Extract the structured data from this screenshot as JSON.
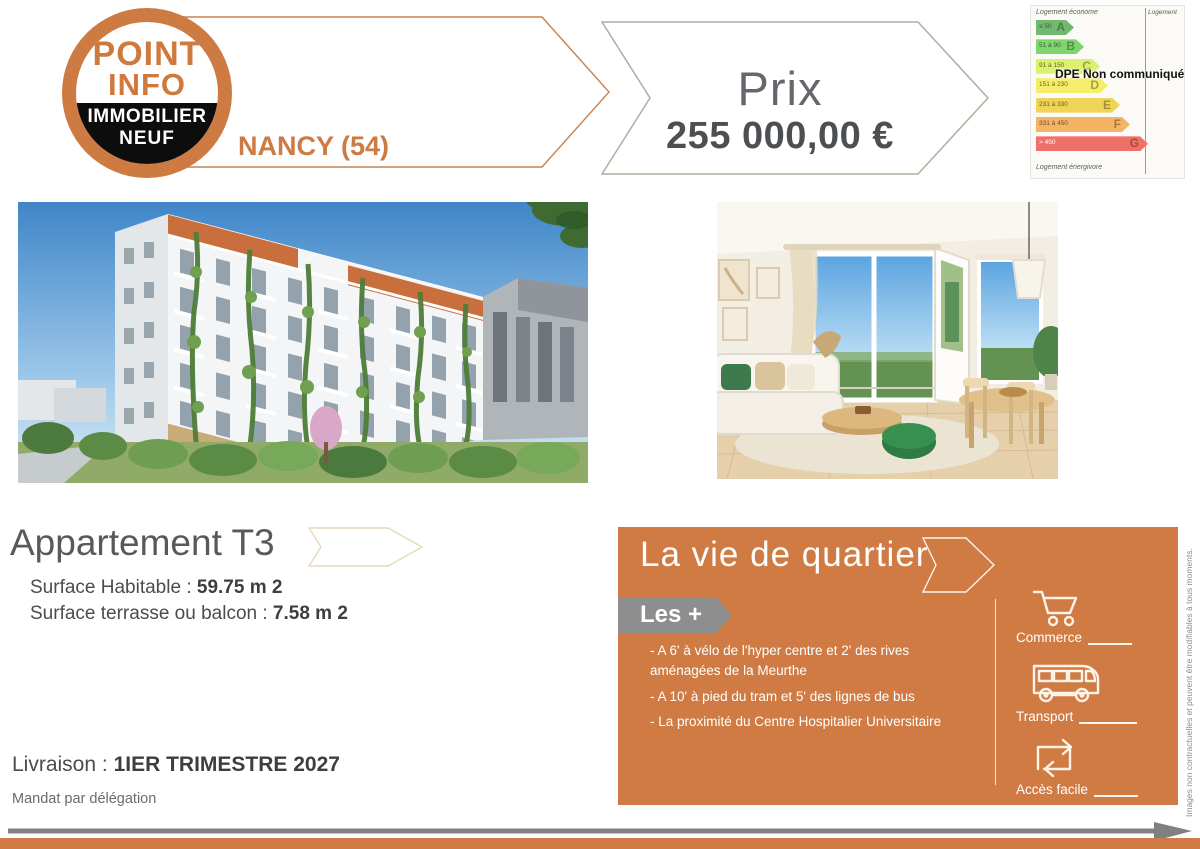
{
  "brand": {
    "logo_line1": "POINT",
    "logo_line2": "INFO",
    "logo_line3": "IMMOBILIER",
    "logo_line4": "NEUF",
    "city": "NANCY (54)",
    "orange": "#cd7a43"
  },
  "price": {
    "label": "Prix",
    "value": "255 000,00 €"
  },
  "dpe": {
    "top_label": "Logement économe",
    "bottom_label": "Logement énergivore",
    "right_label": "Logement",
    "overlay": "DPE Non communiqué",
    "bars": [
      {
        "range": "≤ 50",
        "letter": "A",
        "color": "#70b96f",
        "width": "38px",
        "range_color": "#3e5a3c"
      },
      {
        "range": "51 à 90",
        "letter": "B",
        "color": "#7ed46d",
        "width": "48px",
        "range_color": "#3e5a3c"
      },
      {
        "range": "91 à 150",
        "letter": "C",
        "color": "#d9f16b",
        "width": "64px",
        "range_color": "#5e6336"
      },
      {
        "range": "151 à 230",
        "letter": "D",
        "color": "#f6ee6a",
        "width": "72px",
        "range_color": "#5e6336"
      },
      {
        "range": "231 à 330",
        "letter": "E",
        "color": "#f0d458",
        "width": "84px",
        "range_color": "#5e5a30"
      },
      {
        "range": "331 à 450",
        "letter": "F",
        "color": "#f3b465",
        "width": "94px",
        "range_color": "#6b4f2a"
      },
      {
        "range": "> 450",
        "letter": "G",
        "color": "#ef7066",
        "width": "112px",
        "range_color": "#ffffff"
      }
    ]
  },
  "property": {
    "title": "Appartement T3",
    "surface_label": "Surface Habitable :",
    "surface_value": "59.75 m 2",
    "terrace_label": "Surface terrasse ou balcon  :",
    "terrace_value": "7.58 m 2",
    "delivery_label": "Livraison :",
    "delivery_value": "1IER TRIMESTRE 2027",
    "mandate": "Mandat par délégation"
  },
  "quartier": {
    "title": "La vie de quartier",
    "badge": "Les +",
    "bullets": [
      "- A 6' à vélo de l'hyper centre et 2' des rives aménagées de la Meurthe",
      "- A 10' à pied du tram et 5' des lignes de bus",
      "- La proximité du Centre Hospitalier Universitaire"
    ],
    "amenities": [
      {
        "icon": "shopping-cart-icon",
        "label": "Commerce"
      },
      {
        "icon": "bus-icon",
        "label": "Transport"
      },
      {
        "icon": "easy-access-icon",
        "label": "Accès facile"
      }
    ],
    "box_color": "#d07a44"
  },
  "footer": {
    "disclaimer": "Images non contractuelles et peuvent être modifiables à tous moments."
  }
}
